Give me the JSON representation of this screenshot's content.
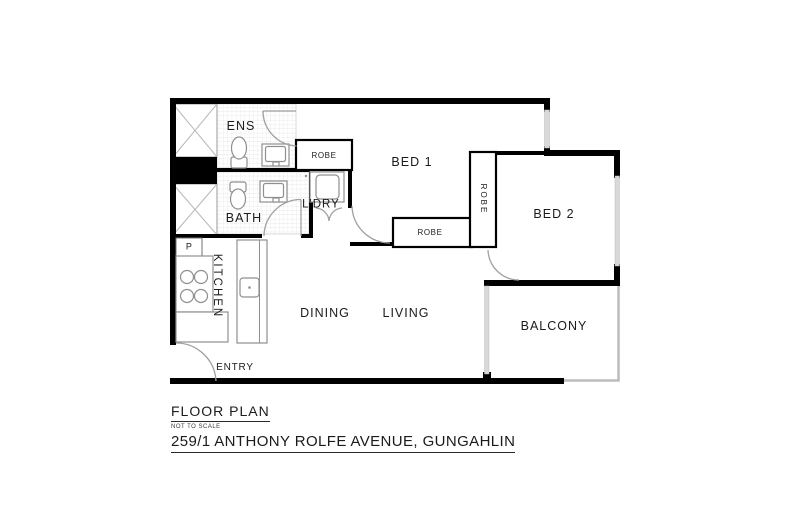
{
  "plan": {
    "rooms": {
      "ens": "ENS",
      "bath": "BATH",
      "ldry": "L'DRY",
      "bed1": "BED 1",
      "bed2": "BED 2",
      "robe_ens": "ROBE",
      "robe_bed1": "ROBE",
      "robe_bed2": "ROBE",
      "kitchen": "KITCHEN",
      "pantry": "P",
      "dining": "DINING",
      "living": "LIVING",
      "balcony": "BALCONY",
      "entry": "ENTRY"
    }
  },
  "title_block": {
    "title": "FLOOR PLAN",
    "scale_note": "NOT TO SCALE",
    "address": "259/1 ANTHONY ROLFE AVENUE, GUNGAHLIN"
  },
  "colors": {
    "wall": "#000000",
    "glass": "#d9d9d9",
    "railing": "#bcbcbc",
    "fixture": "#8f8f8f",
    "door": "#a0a0a0",
    "text": "#1b1b1b",
    "bg": "#ffffff"
  }
}
